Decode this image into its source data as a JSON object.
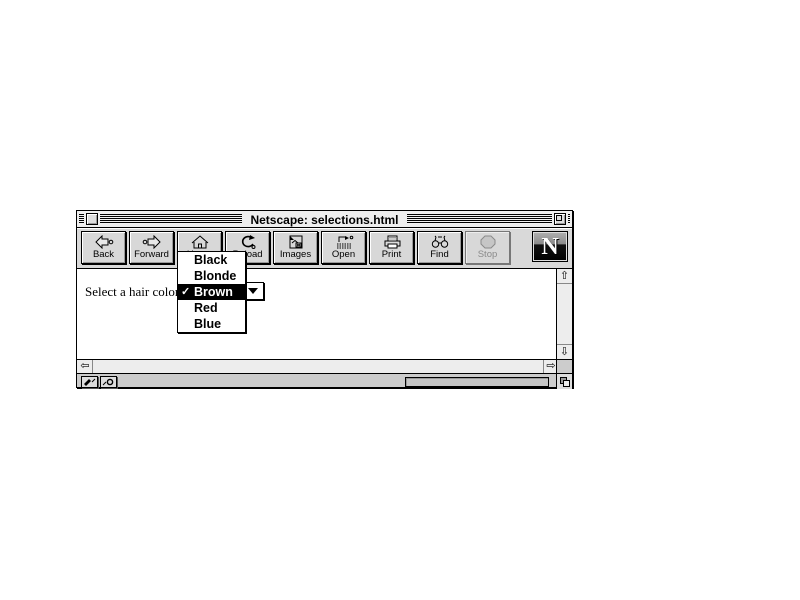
{
  "window": {
    "title": "Netscape: selections.html"
  },
  "toolbar": {
    "buttons": [
      {
        "label": "Back",
        "icon": "back-arrow-icon",
        "enabled": true
      },
      {
        "label": "Forward",
        "icon": "forward-arrow-icon",
        "enabled": true
      },
      {
        "label": "Home",
        "icon": "home-house-icon",
        "enabled": true
      },
      {
        "label": "Reload",
        "icon": "reload-circular-arrow-icon",
        "enabled": true
      },
      {
        "label": "Images",
        "icon": "images-picture-icon",
        "enabled": true
      },
      {
        "label": "Open",
        "icon": "open-location-icon",
        "enabled": true
      },
      {
        "label": "Print",
        "icon": "printer-icon",
        "enabled": true
      },
      {
        "label": "Find",
        "icon": "binoculars-icon",
        "enabled": true
      },
      {
        "label": "Stop",
        "icon": "stop-octagon-icon",
        "enabled": false
      }
    ],
    "logo_letter": "N"
  },
  "content": {
    "prompt_label": "Select a hair color:",
    "hair_color_select": {
      "options": [
        "Black",
        "Blonde",
        "Brown",
        "Red",
        "Blue"
      ],
      "selected_value": "Brown",
      "checkmark_glyph": "✓"
    }
  },
  "scrollbars": {
    "up_arrow": "⇧",
    "down_arrow": "⇩",
    "left_arrow": "⇦",
    "right_arrow": "⇨"
  },
  "status_bar": {
    "progress_percent": 0
  },
  "colors": {
    "toolbar_bg": "#d9d9d9",
    "menu_highlight_bg": "#000000",
    "menu_highlight_text": "#ffffff",
    "disabled_text": "#8a8a8a",
    "window_bg": "#ffffff"
  }
}
